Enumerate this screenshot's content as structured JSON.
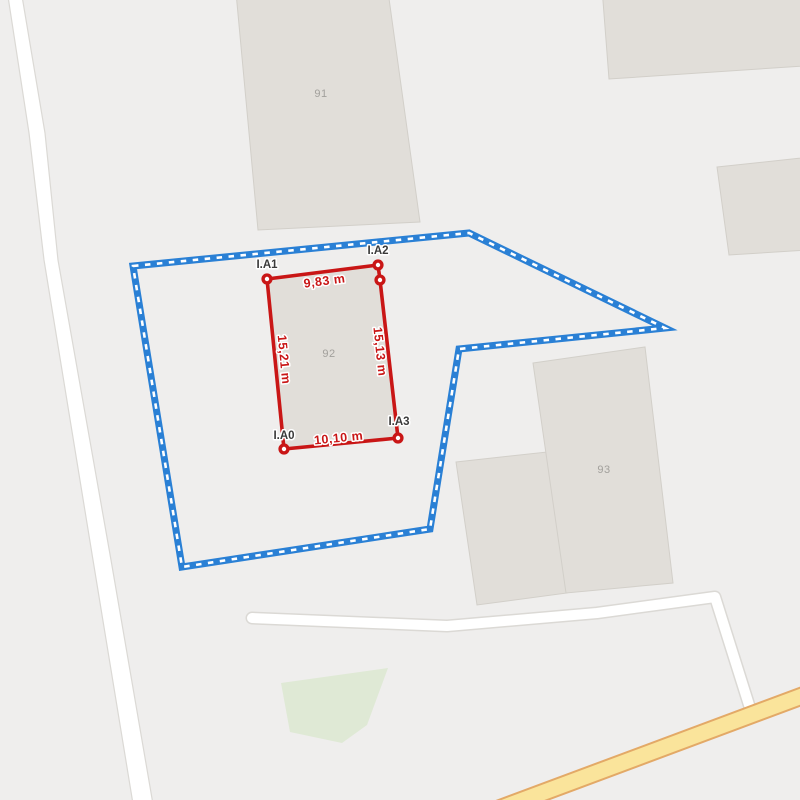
{
  "map": {
    "colors": {
      "background": "#efeeed",
      "building_fill": "#e1ded9",
      "building_border": "#d2cfc9",
      "road_fill": "#ffffff",
      "road_casing": "#dbd9d5",
      "highway_fill": "#fae49b",
      "highway_casing": "#e3a967",
      "green_area_fill": "#dfe9d5",
      "parcel_label_color": "#a2a09c"
    },
    "parcel_labels": [
      {
        "text": "91"
      },
      {
        "text": "92"
      },
      {
        "text": "93"
      }
    ]
  },
  "boundary": {
    "line_color": "#2a80d5",
    "dash_color": "#ffffff"
  },
  "measurement": {
    "line_color": "#c91616",
    "label_color": "#3a3a3a",
    "halo_color": "#ffffff",
    "points": [
      {
        "label": "I.A0"
      },
      {
        "label": "I.A1"
      },
      {
        "label": "I.A2"
      },
      {
        "label": "I.A3"
      }
    ],
    "edges": [
      {
        "label": "9,83 m"
      },
      {
        "label": "15,13 m"
      },
      {
        "label": "10,10 m"
      },
      {
        "label": "15,21 m"
      }
    ]
  }
}
